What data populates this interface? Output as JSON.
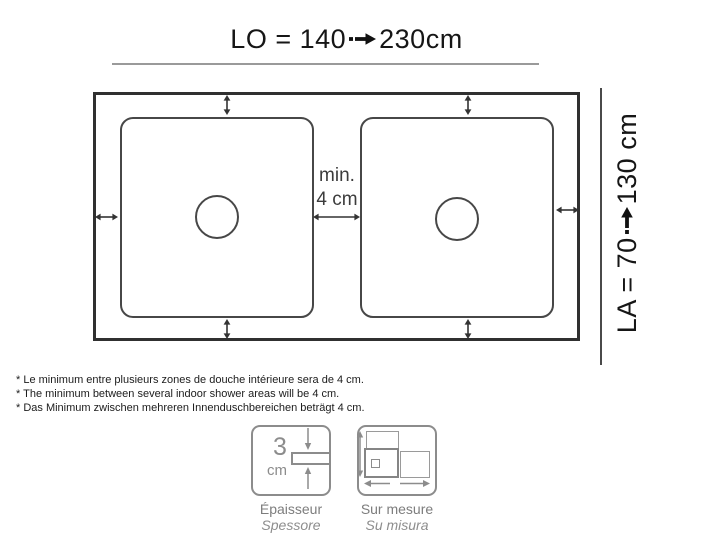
{
  "diagram": {
    "length_label": {
      "prefix": "LO = 140",
      "suffix": "230cm"
    },
    "width_label": {
      "prefix": "LA = 70",
      "suffix": "130 cm"
    },
    "gap_label": {
      "line1": "min.",
      "line2": "4 cm"
    }
  },
  "footnotes": [
    "* Le minimum entre plusieurs zones de douche intérieure sera de 4 cm.",
    "* The minimum between several indoor shower areas will be 4 cm.",
    "* Das Minimum zwischen mehreren Innenduschbereichen beträgt 4 cm."
  ],
  "legend": {
    "thickness": {
      "value": "3",
      "unit": "cm",
      "label": "Épaisseur",
      "label_alt": "Spessore"
    },
    "custom_size": {
      "label": "Sur mesure",
      "label_alt": "Su misura"
    }
  },
  "colors": {
    "line_dark": "#303030",
    "line_medium": "#474747",
    "icon_gray": "#8c8c8c",
    "label_gray": "#7d7d7d"
  }
}
